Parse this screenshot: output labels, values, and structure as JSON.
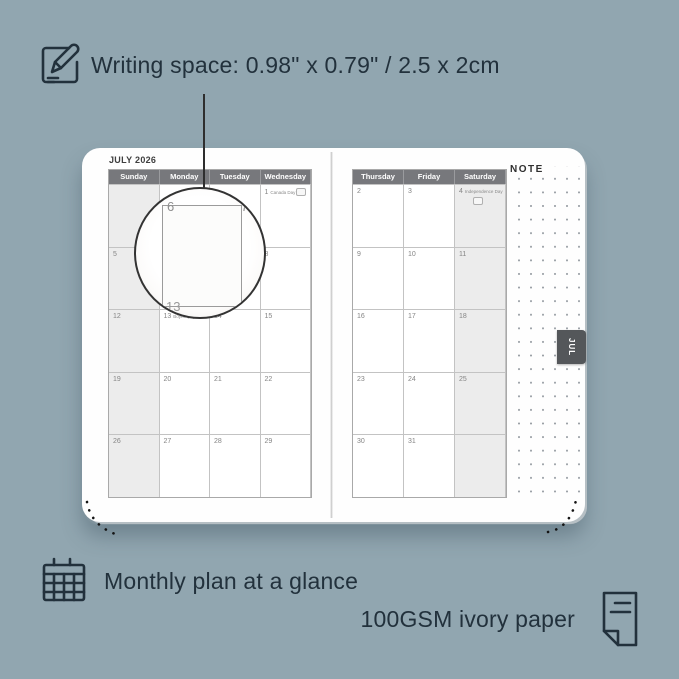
{
  "background": "#91a6b0",
  "ink": "#22313c",
  "colors": {
    "header_bar": "#77787c",
    "weekend_shade": "#ececec",
    "tab_bg": "#54575a",
    "page": "#fefefe"
  },
  "annotations": {
    "writing_space": "Writing space: 0.98\" x 0.79\" / 2.5 x 2cm",
    "monthly_plan": "Monthly plan at a glance",
    "paper": "100GSM ivory paper"
  },
  "planner": {
    "month_title": "JULY 2026",
    "note_label": "NOTE",
    "tab_label": "JUL",
    "left_page": {
      "headers": [
        "Sunday",
        "Monday",
        "Tuesday",
        "Wednesday"
      ],
      "weekend_column_index": 0,
      "rows": [
        [
          {
            "d": ""
          },
          {
            "d": ""
          },
          {
            "d": ""
          },
          {
            "d": "1",
            "e": "Canada Day",
            "f": true
          }
        ],
        [
          {
            "d": "5"
          },
          {
            "d": "6"
          },
          {
            "d": "7"
          },
          {
            "d": "8"
          }
        ],
        [
          {
            "d": "12"
          },
          {
            "d": "13",
            "e": "Boyne (NI)"
          },
          {
            "d": "14"
          },
          {
            "d": "15"
          }
        ],
        [
          {
            "d": "19"
          },
          {
            "d": "20"
          },
          {
            "d": "21"
          },
          {
            "d": "22"
          }
        ],
        [
          {
            "d": "26"
          },
          {
            "d": "27"
          },
          {
            "d": "28"
          },
          {
            "d": "29"
          }
        ]
      ]
    },
    "right_page": {
      "headers": [
        "Thursday",
        "Friday",
        "Saturday"
      ],
      "weekend_column_index": 2,
      "rows": [
        [
          {
            "d": "2"
          },
          {
            "d": "3"
          },
          {
            "d": "4",
            "e": "Independence Day",
            "f": true
          }
        ],
        [
          {
            "d": "9"
          },
          {
            "d": "10"
          },
          {
            "d": "11"
          }
        ],
        [
          {
            "d": "16"
          },
          {
            "d": "17"
          },
          {
            "d": "18"
          }
        ],
        [
          {
            "d": "23"
          },
          {
            "d": "24"
          },
          {
            "d": "25"
          }
        ],
        [
          {
            "d": "30"
          },
          {
            "d": "31"
          },
          {
            "d": ""
          }
        ]
      ]
    },
    "magnifier": {
      "left_day": "6",
      "right_day": "7",
      "next_day": "13"
    }
  }
}
